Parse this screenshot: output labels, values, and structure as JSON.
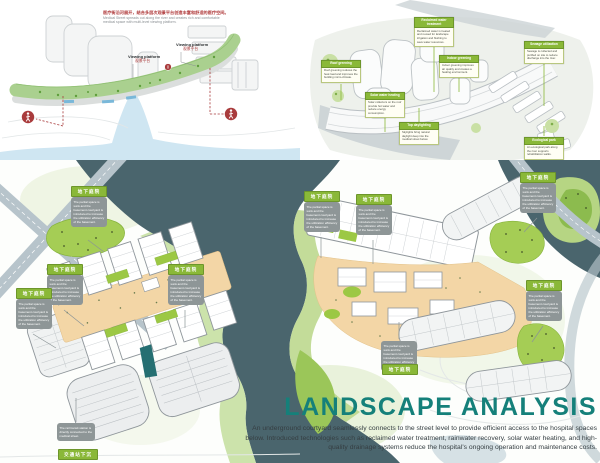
{
  "meta": {
    "board_title": "Landscape Analysis presentation board"
  },
  "colors": {
    "accent_green": "#8ab838",
    "lawn_green": "#a5cd55",
    "water_dark": "#4a656d",
    "water_light": "#cfe6f2",
    "courtyard_orange": "#f3d6a6",
    "annotation_gray": "#8e9697",
    "title_teal": "#15807a",
    "accent_red": "#a93b3c"
  },
  "top_left": {
    "caption_zh": "医疗街沿河展开，结合多层次观景平台创造丰富和舒适的医疗空间。",
    "caption_en_line1": "Medical Street spreads out along the river and creates rich and comfortable",
    "caption_en_line2": "medical space with multi-level viewing platform.",
    "viewing": {
      "en": "Viewing platform",
      "zh": "观景平台"
    },
    "pedestrian_icon": "pedestrian-icon"
  },
  "top_right": {
    "labels": [
      {
        "title": "Reclaimed water treatment",
        "body": "Reclaimed water is treated and reused for landscape irrigation and flushing to save water resources."
      },
      {
        "title": "Sewage utilization",
        "body": "Sewage is collected and purified on site to reduce discharge into the river."
      },
      {
        "title": "Roof greening",
        "body": "Roof greening reduces the heat load and improves the building micro-climate."
      },
      {
        "title": "Indoor greening",
        "body": "Indoor greening improves air quality and creates a healing environment."
      },
      {
        "title": "Solar water heating",
        "body": "Solar collectors on the roof provide hot water and reduce energy consumption."
      },
      {
        "title": "Top daylighting",
        "body": "Skylights bring natural daylight deep into the medical street below."
      },
      {
        "title": "Ecological park",
        "body": "An ecological park along the river supports rehabilitation walks."
      }
    ]
  },
  "site_plan": {
    "underground_label": "地下庭院",
    "underground_note": "The partial space is sunk and the basement courtyard is introduced to increase the utilization efficiency of the basement.",
    "station_label": "交通站下沉",
    "station_note": "The rail transit station is directly connected to the medical street."
  },
  "title_block": {
    "title": "LANDSCAPE ANALYSIS",
    "body_line1": "An underground courtyard seamlessly connects to the street level to provide efficient access to the hospital spaces",
    "body_line2": "below. Introduced technologies such as reclaimed water treatment, rainwater recovery, solar water heating, and high-",
    "body_line3": "quality drainage systems reduce the hospital's ongoing operation and maintenance costs."
  }
}
